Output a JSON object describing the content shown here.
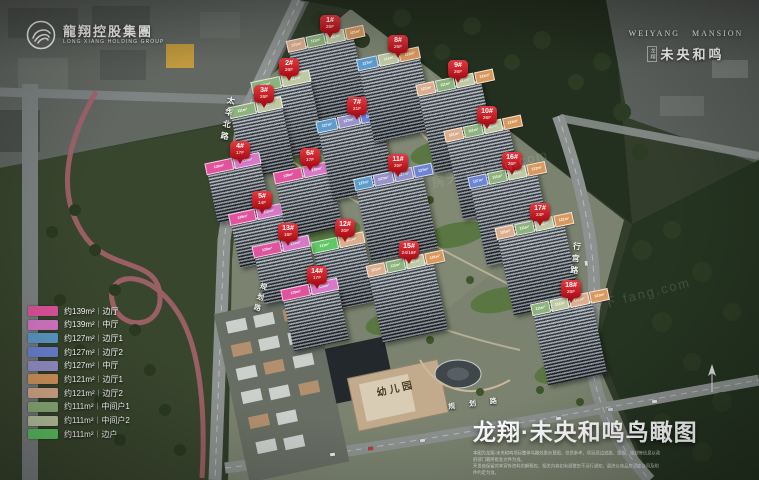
{
  "branding": {
    "left_logo": {
      "cn": "龍翔控股集團",
      "en": "LONG XIANG HOLDING GROUP"
    },
    "right_logo": {
      "en_left": "WEIYANG",
      "en_right": "MANSION",
      "cn_prefix": "龙翔",
      "cn": "未央和鸣"
    }
  },
  "title": {
    "text": "龙翔·未央和鸣鸟瞰图",
    "disclaimer_line1": "本图为龙翔·未央和鸣项目整体鸟瞰效果示意图，仅供参考，项目周边道路、景观、规划等信息以政府部门最终批准文件为准。",
    "disclaimer_line2": "开发商保留对本宣传资料的解释权，相关内容如有调整恕不另行通知，最终以商品房买卖合同及附件约定为准。"
  },
  "legend": {
    "items": [
      {
        "color": "#e0549e",
        "area": "约139m²",
        "type": "边厅"
      },
      {
        "color": "#d879c8",
        "area": "约139m²",
        "type": "中厅"
      },
      {
        "color": "#5d9ccb",
        "area": "约127m²",
        "type": "边厅1"
      },
      {
        "color": "#6d84d6",
        "area": "约127m²",
        "type": "边厅2"
      },
      {
        "color": "#9893cb",
        "area": "约127m²",
        "type": "中厅"
      },
      {
        "color": "#d9995e",
        "area": "约121m²",
        "type": "边厅1"
      },
      {
        "color": "#dcae8e",
        "area": "约121m²",
        "type": "边厅2"
      },
      {
        "color": "#8fb37e",
        "area": "约111m²",
        "type": "中间户1"
      },
      {
        "color": "#bfcaa4",
        "area": "约111m²",
        "type": "中间户2"
      },
      {
        "color": "#5fc763",
        "area": "约111m²",
        "type": "边户"
      }
    ]
  },
  "buildings": [
    {
      "id": "1#",
      "floors": "26F",
      "marker": {
        "x": 320,
        "y": 15
      },
      "tower": {
        "x": 296,
        "y": 42,
        "w": 66,
        "h": 76
      },
      "panels": [
        {
          "a": "121m²",
          "c": "#dcae8e"
        },
        {
          "a": "111m²",
          "c": "#8fb37e"
        },
        {
          "a": "111m²",
          "c": "#bfcaa4"
        },
        {
          "a": "121m²",
          "c": "#d9995e"
        }
      ]
    },
    {
      "id": "2#",
      "floors": "26F",
      "marker": {
        "x": 279,
        "y": 58
      },
      "tower": {
        "x": 260,
        "y": 84,
        "w": 58,
        "h": 70
      },
      "panels": [
        {
          "a": "111m²",
          "c": "#8fb37e"
        },
        {
          "a": "111m²",
          "c": "#bfcaa4"
        }
      ]
    },
    {
      "id": "3#",
      "floors": "26F",
      "marker": {
        "x": 254,
        "y": 85
      },
      "tower": {
        "x": 237,
        "y": 110,
        "w": 52,
        "h": 62
      },
      "panels": [
        {
          "a": "111m²",
          "c": "#8fb37e"
        },
        {
          "a": "111m²",
          "c": "#bfcaa4"
        }
      ]
    },
    {
      "id": "4#",
      "floors": "17F",
      "marker": {
        "x": 230,
        "y": 141
      },
      "tower": {
        "x": 212,
        "y": 166,
        "w": 54,
        "h": 50
      },
      "panels": [
        {
          "a": "139m²",
          "c": "#e0549e"
        },
        {
          "a": "139m²",
          "c": "#d879c8"
        }
      ]
    },
    {
      "id": "5#",
      "floors": "14F",
      "marker": {
        "x": 252,
        "y": 191
      },
      "tower": {
        "x": 235,
        "y": 217,
        "w": 52,
        "h": 44
      },
      "panels": [
        {
          "a": "139m²",
          "c": "#e0549e"
        },
        {
          "a": "139m²",
          "c": "#d879c8"
        }
      ]
    },
    {
      "id": "6#",
      "floors": "17F",
      "marker": {
        "x": 300,
        "y": 148
      },
      "tower": {
        "x": 281,
        "y": 175,
        "w": 56,
        "h": 56
      },
      "panels": [
        {
          "a": "139m²",
          "c": "#e0549e"
        },
        {
          "a": "139m²",
          "c": "#d879c8"
        }
      ]
    },
    {
      "id": "7#",
      "floors": "21F",
      "marker": {
        "x": 347,
        "y": 97
      },
      "tower": {
        "x": 325,
        "y": 123,
        "w": 64,
        "h": 70
      },
      "panels": [
        {
          "a": "127m²",
          "c": "#5d9ccb"
        },
        {
          "a": "127m²",
          "c": "#9893cb"
        },
        {
          "a": "127m²",
          "c": "#6d84d6"
        }
      ]
    },
    {
      "id": "8#",
      "floors": "26F",
      "marker": {
        "x": 388,
        "y": 35
      },
      "tower": {
        "x": 366,
        "y": 61,
        "w": 62,
        "h": 74
      },
      "panels": [
        {
          "a": "127m²",
          "c": "#5d9ccb"
        },
        {
          "a": "111m²",
          "c": "#bfcaa4"
        },
        {
          "a": "121m²",
          "c": "#d9995e"
        }
      ]
    },
    {
      "id": "9#",
      "floors": "26F",
      "marker": {
        "x": 448,
        "y": 60
      },
      "tower": {
        "x": 426,
        "y": 86,
        "w": 64,
        "h": 80
      },
      "panels": [
        {
          "a": "121m²",
          "c": "#dcae8e"
        },
        {
          "a": "111m²",
          "c": "#8fb37e"
        },
        {
          "a": "111m²",
          "c": "#bfcaa4"
        },
        {
          "a": "121m²",
          "c": "#d9995e"
        }
      ]
    },
    {
      "id": "10#",
      "floors": "26F",
      "marker": {
        "x": 477,
        "y": 106
      },
      "tower": {
        "x": 454,
        "y": 132,
        "w": 64,
        "h": 80
      },
      "panels": [
        {
          "a": "121m²",
          "c": "#dcae8e"
        },
        {
          "a": "111m²",
          "c": "#8fb37e"
        },
        {
          "a": "111m²",
          "c": "#bfcaa4"
        },
        {
          "a": "121m²",
          "c": "#d9995e"
        }
      ]
    },
    {
      "id": "11#",
      "floors": "25F",
      "marker": {
        "x": 388,
        "y": 154
      },
      "tower": {
        "x": 363,
        "y": 180,
        "w": 68,
        "h": 74
      },
      "panels": [
        {
          "a": "127m²",
          "c": "#5d9ccb"
        },
        {
          "a": "127m²",
          "c": "#9893cb"
        },
        {
          "a": "127m²",
          "c": "#9893cb"
        },
        {
          "a": "127m²",
          "c": "#6d84d6"
        }
      ]
    },
    {
      "id": "12#",
      "floors": "20F",
      "marker": {
        "x": 335,
        "y": 219
      },
      "tower": {
        "x": 319,
        "y": 245,
        "w": 52,
        "h": 60
      },
      "panels": [
        {
          "a": "111m²",
          "c": "#5fc763"
        },
        {
          "a": "121m²",
          "c": "#dcae8e"
        }
      ]
    },
    {
      "id": "13#",
      "floors": "16F",
      "marker": {
        "x": 278,
        "y": 223
      },
      "tower": {
        "x": 259,
        "y": 249,
        "w": 56,
        "h": 48
      },
      "panels": [
        {
          "a": "139m²",
          "c": "#e0549e"
        },
        {
          "a": "139m²",
          "c": "#d879c8"
        }
      ]
    },
    {
      "id": "14#",
      "floors": "17F",
      "marker": {
        "x": 307,
        "y": 266
      },
      "tower": {
        "x": 288,
        "y": 292,
        "w": 56,
        "h": 52
      },
      "panels": [
        {
          "a": "139m²",
          "c": "#e0549e"
        },
        {
          "a": "139m²",
          "c": "#d879c8"
        }
      ]
    },
    {
      "id": "15#",
      "floors": "24/16F",
      "marker": {
        "x": 399,
        "y": 241
      },
      "tower": {
        "x": 375,
        "y": 267,
        "w": 66,
        "h": 68
      },
      "panels": [
        {
          "a": "121m²",
          "c": "#dcae8e"
        },
        {
          "a": "111m²",
          "c": "#8fb37e"
        },
        {
          "a": "111m²",
          "c": "#bfcaa4"
        },
        {
          "a": "121m²",
          "c": "#d9995e"
        }
      ]
    },
    {
      "id": "16#",
      "floors": "26F",
      "marker": {
        "x": 502,
        "y": 152
      },
      "tower": {
        "x": 478,
        "y": 178,
        "w": 68,
        "h": 80
      },
      "panels": [
        {
          "a": "127m²",
          "c": "#6d84d6"
        },
        {
          "a": "111m²",
          "c": "#8fb37e"
        },
        {
          "a": "111m²",
          "c": "#bfcaa4"
        },
        {
          "a": "121m²",
          "c": "#d9995e"
        }
      ]
    },
    {
      "id": "17#",
      "floors": "24F",
      "marker": {
        "x": 530,
        "y": 203
      },
      "tower": {
        "x": 505,
        "y": 229,
        "w": 68,
        "h": 78
      },
      "panels": [
        {
          "a": "121m²",
          "c": "#dcae8e"
        },
        {
          "a": "111m²",
          "c": "#8fb37e"
        },
        {
          "a": "111m²",
          "c": "#bfcaa4"
        },
        {
          "a": "121m²",
          "c": "#d9995e"
        }
      ]
    },
    {
      "id": "18#",
      "floors": "26F",
      "marker": {
        "x": 561,
        "y": 280
      },
      "tower": {
        "x": 540,
        "y": 306,
        "w": 60,
        "h": 72
      },
      "panels": [
        {
          "a": "111m²",
          "c": "#8fb37e"
        },
        {
          "a": "111m²",
          "c": "#bfcaa4"
        },
        {
          "a": "121m²",
          "c": "#dcae8e"
        },
        {
          "a": "121m²",
          "c": "#d9995e"
        }
      ]
    }
  ],
  "road_labels": [
    {
      "text": "太华北路",
      "x": 222,
      "y": 96,
      "dir": "v",
      "rot": 10,
      "fs": 8
    },
    {
      "text": "规划路",
      "x": 254,
      "y": 282,
      "dir": "v",
      "rot": 16,
      "fs": 7
    },
    {
      "text": "行宫路",
      "x": 570,
      "y": 242,
      "dir": "v",
      "rot": 6,
      "fs": 8
    },
    {
      "text": "规划路",
      "x": 448,
      "y": 398,
      "dir": "h",
      "rot": -7,
      "fs": 7,
      "ls": 14
    }
  ],
  "site_labels": [
    {
      "text": "幼儿园",
      "x": 376,
      "y": 380,
      "rot": -13,
      "fs": 10,
      "color": "#4a3a26",
      "ls": 3
    }
  ],
  "watermarks": [
    {
      "text": "房天下 fang.com",
      "x": 430,
      "y": 158
    },
    {
      "text": "房天下 fang.com",
      "x": 572,
      "y": 286
    }
  ],
  "cars": [
    [
      330,
      453,
      -7,
      "#e9ebec"
    ],
    [
      368,
      447,
      -7,
      "#c0392f"
    ],
    [
      420,
      439,
      -7,
      "#dadde0"
    ],
    [
      505,
      425,
      -7,
      "#2d3237"
    ],
    [
      556,
      417,
      -7,
      "#e4e7e9"
    ],
    [
      608,
      408,
      -7,
      "#cdd1d4"
    ],
    [
      652,
      400,
      -7,
      "#e8eaec"
    ],
    [
      590,
      300,
      85,
      "#dfe2e4"
    ],
    [
      584,
      262,
      83,
      "#d6dadd"
    ],
    [
      236,
      168,
      75,
      "#e6e8ea"
    ],
    [
      243,
      120,
      72,
      "#d9dcde"
    ]
  ]
}
